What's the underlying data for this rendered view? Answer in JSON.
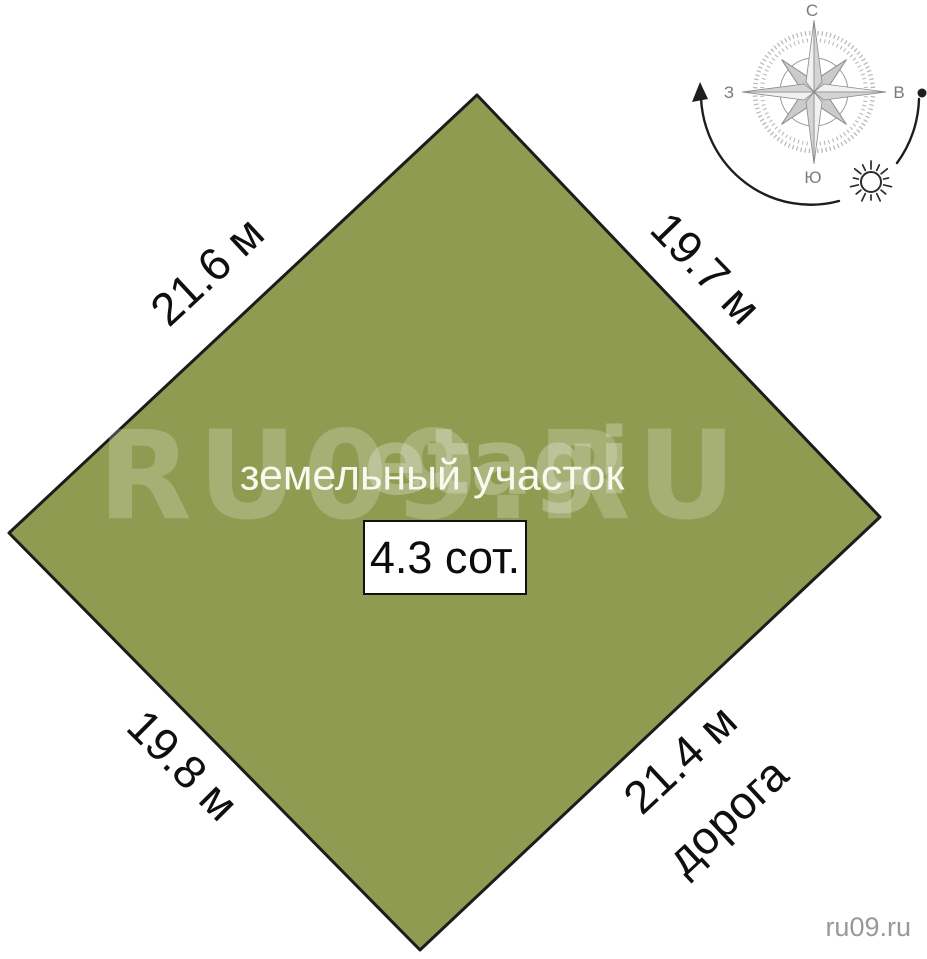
{
  "scene": {
    "title": "земельный участок",
    "area_label": "4.3 сот."
  },
  "dimensions": {
    "top_left": "21.6 м",
    "top_right": "19.7 м",
    "bottom_left": "19.8 м",
    "bottom_right": "21.4 м"
  },
  "road_label": "дорога",
  "compass": {
    "north": "С",
    "south": "Ю",
    "west": "З",
    "east": "В"
  },
  "watermarks": {
    "large": "RU09.RU",
    "brand": "etagi",
    "corner": "ru09.ru"
  },
  "colors": {
    "plot_fill": "#909b52",
    "plot_border": "#1c1c1c"
  }
}
